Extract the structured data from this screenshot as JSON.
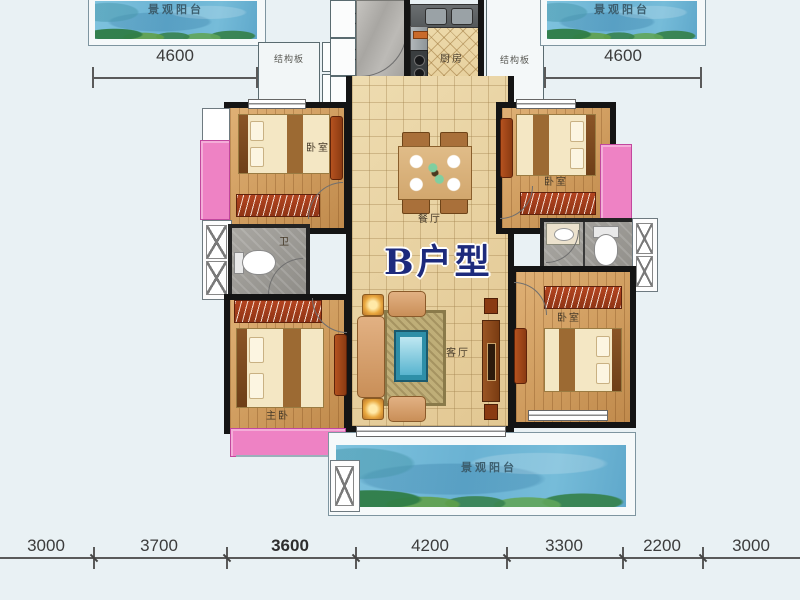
{
  "unit_title": "B户型",
  "labels": {
    "balcony": "景观阳台",
    "structural_panel": "结构板",
    "kitchen": "厨房",
    "dining_room": "餐厅",
    "living_room": "客厅",
    "bedroom": "卧室",
    "master_bedroom": "主卧",
    "bathroom": "卫"
  },
  "dimensions": {
    "top_left": "4600",
    "top_right": "4600",
    "bottom": [
      "3000",
      "3700",
      "3600",
      "4200",
      "3300",
      "2200",
      "3000"
    ]
  },
  "colors": {
    "background": "#e9f1f4",
    "water": "#74bad8",
    "bay_window": "#ee82c4",
    "wall": "#141414",
    "title": "#1d2a7c"
  }
}
